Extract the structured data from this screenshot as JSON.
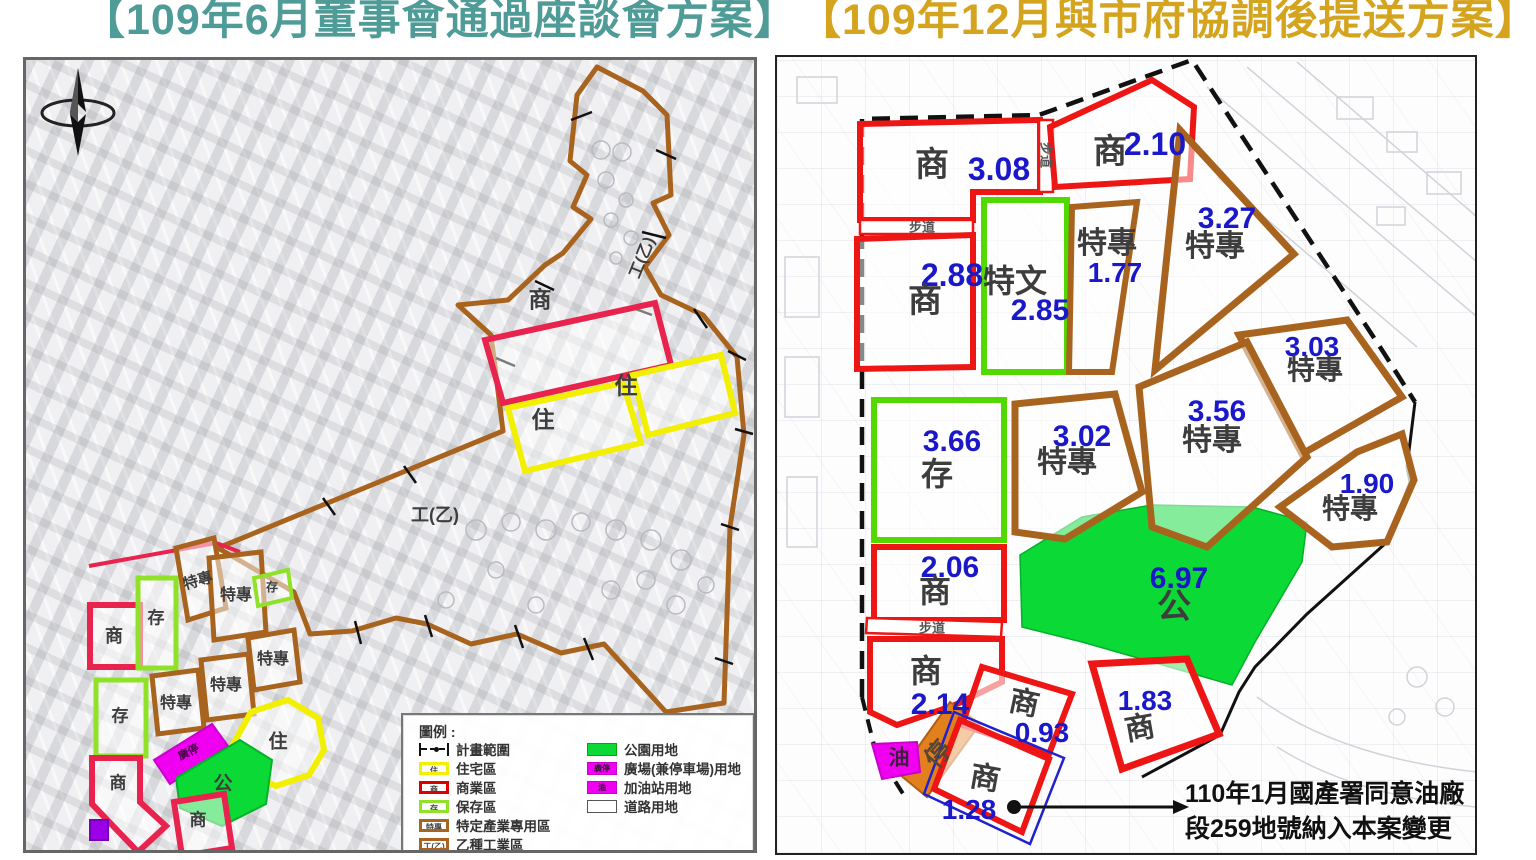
{
  "titles": {
    "left": "【109年6月董事會通過座談會方案】",
    "right": "【109年12月與市府協調後提送方案】"
  },
  "colors": {
    "left_title": "#4F9B97",
    "right_title": "#D5A41F",
    "commercial_red": "#EE1515",
    "commercial_crimson": "#E8234D",
    "residential_yellow": "#F2EF00",
    "preserve_green": "#52D900",
    "park_green": "#0AD936",
    "special_brown": "#A8641E",
    "plaza_magenta": "#F000F0",
    "gas_magenta": "#F000F0",
    "parking_orange": "#E2801E",
    "number_blue": "#1A18C9",
    "boundary_black": "#111111"
  },
  "left_map": {
    "compass": "north-arrow",
    "industrial_labels": [
      {
        "text": "工(乙)"
      },
      {
        "text": "工(乙)"
      }
    ],
    "zones": [
      {
        "label": "商"
      },
      {
        "label": "住"
      },
      {
        "label": "住"
      },
      {
        "label": "商"
      },
      {
        "label": "存"
      },
      {
        "label": "特專"
      },
      {
        "label": "特專"
      },
      {
        "label": "存"
      },
      {
        "label": "特專"
      },
      {
        "label": "特專"
      },
      {
        "label": "特專"
      },
      {
        "label": "存"
      },
      {
        "label": "廣停"
      },
      {
        "label": "住"
      },
      {
        "label": "公"
      },
      {
        "label": "商"
      },
      {
        "label": "商"
      }
    ],
    "legend": {
      "title": "圖例 :",
      "col1": [
        {
          "label": "計畫範圍",
          "swatch": "boundary"
        },
        {
          "label": "住宅區",
          "swatch": "residential",
          "glyph": "住"
        },
        {
          "label": "商業區",
          "swatch": "commercial",
          "glyph": "商"
        },
        {
          "label": "保存區",
          "swatch": "preserve",
          "glyph": "存"
        },
        {
          "label": "特定產業專用區",
          "swatch": "special",
          "glyph": "特專"
        },
        {
          "label": "乙種工業區",
          "swatch": "industrial",
          "glyph": "工(乙)"
        }
      ],
      "col2": [
        {
          "label": "公園用地",
          "swatch": "park"
        },
        {
          "label": "廣場(兼停車場)用地",
          "swatch": "plaza",
          "glyph": "廣停"
        },
        {
          "label": "加油站用地",
          "swatch": "gas",
          "glyph": "油"
        },
        {
          "label": "道路用地",
          "swatch": "road"
        }
      ]
    }
  },
  "right_map": {
    "zones": [
      {
        "label": "商",
        "value": "3.08"
      },
      {
        "label": "商",
        "value": "2.10"
      },
      {
        "label": "商",
        "value": "2.88"
      },
      {
        "label": "特文",
        "value": "2.85"
      },
      {
        "label": "特專",
        "value": "1.77"
      },
      {
        "label": "特專",
        "value": "3.27"
      },
      {
        "label": "特專",
        "value": "3.03"
      },
      {
        "label": "特專",
        "value": "3.56"
      },
      {
        "label": "特專",
        "value": "3.02"
      },
      {
        "label": "存",
        "value": "3.66"
      },
      {
        "label": "商",
        "value": "2.06"
      },
      {
        "label": "公",
        "value": "6.97"
      },
      {
        "label": "特專",
        "value": "1.90"
      },
      {
        "label": "商",
        "value": "2.14"
      },
      {
        "label": "商",
        "value": "0.93"
      },
      {
        "label": "商",
        "value": "1.83"
      },
      {
        "label": "商",
        "value": "1.28"
      }
    ],
    "path_labels": [
      {
        "text": "步道"
      },
      {
        "text": "步道"
      },
      {
        "text": "步道"
      }
    ],
    "strip_labels": [
      {
        "text": "停"
      },
      {
        "text": "油"
      }
    ],
    "annotation": {
      "line1": "110年1月國產署同意油廠",
      "line2": "段259地號納入本案變更"
    }
  }
}
